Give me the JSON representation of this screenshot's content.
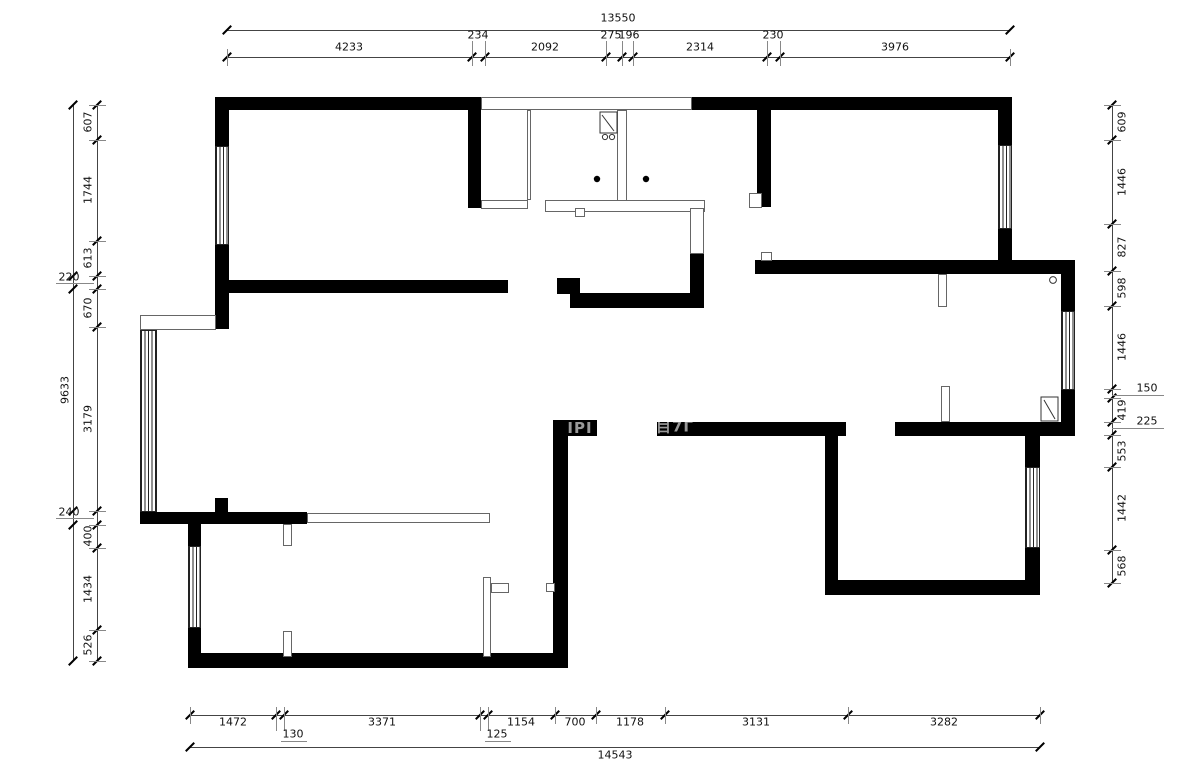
{
  "title": "apartment-floor-plan",
  "colors": {
    "wall": "#000000",
    "dimension_line": "#444444",
    "background": "#ffffff"
  },
  "dimensions": {
    "top": {
      "overall": "13550",
      "segments": [
        "4233",
        "234",
        "2092",
        "275",
        "196",
        "2314",
        "230",
        "3976"
      ]
    },
    "bottom": {
      "overall": "14543",
      "segments": [
        "1472",
        "130",
        "3371",
        "125",
        "1154",
        "700",
        "1178",
        "3131",
        "3282"
      ]
    },
    "left": {
      "overall": "9633",
      "segments": [
        "607",
        "1744",
        "613",
        "220",
        "670",
        "3179",
        "240",
        "400",
        "1434",
        "526"
      ]
    },
    "right": {
      "segments": [
        "609",
        "1446",
        "827",
        "598",
        "1446",
        "150",
        "419",
        "225",
        "553",
        "1442",
        "568"
      ]
    }
  },
  "watermark": {
    "fragments": [
      "IPI",
      "目7Γ"
    ]
  }
}
